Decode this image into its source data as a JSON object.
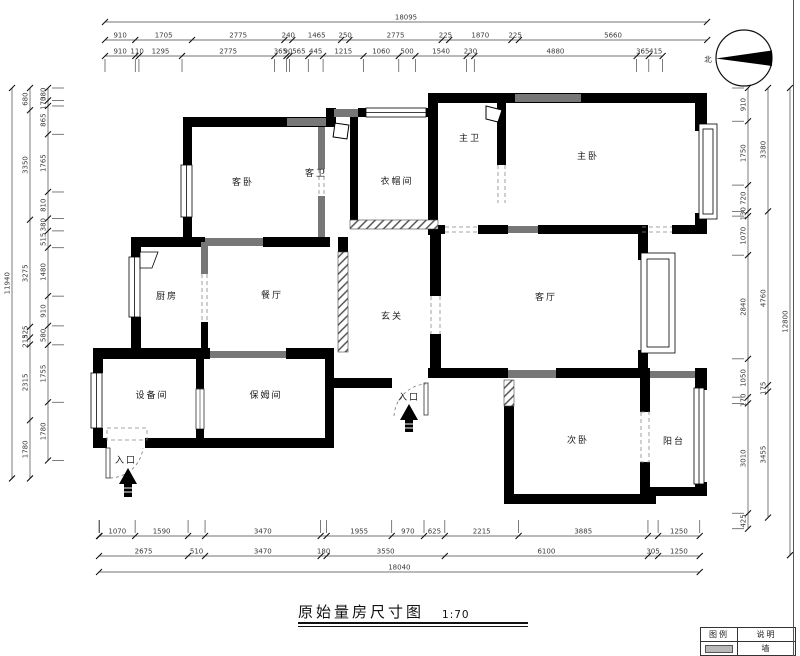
{
  "title": {
    "text": "原始量房尺寸图",
    "scale": "1:70"
  },
  "north_label": "北",
  "legend": {
    "header_symbol": "图例",
    "header_desc": "说明",
    "row1_desc": "墙"
  },
  "labels": [
    {
      "name": "客卧",
      "x": 243,
      "y": 185,
      "s": 9
    },
    {
      "name": "客卫",
      "x": 316,
      "y": 176,
      "s": 8
    },
    {
      "name": "衣帽间",
      "x": 397,
      "y": 184,
      "s": 8.5
    },
    {
      "name": "主卫",
      "x": 470,
      "y": 141,
      "s": 8
    },
    {
      "name": "主卧",
      "x": 588,
      "y": 159,
      "s": 9
    },
    {
      "name": "厨房",
      "x": 167,
      "y": 299,
      "s": 9
    },
    {
      "name": "餐厅",
      "x": 272,
      "y": 298,
      "s": 9
    },
    {
      "name": "玄关",
      "x": 392,
      "y": 319,
      "s": 9
    },
    {
      "name": "客厅",
      "x": 546,
      "y": 300,
      "s": 9
    },
    {
      "name": "设备间",
      "x": 152,
      "y": 398,
      "s": 8.5
    },
    {
      "name": "保姆间",
      "x": 266,
      "y": 398,
      "s": 8.5
    },
    {
      "name": "次卧",
      "x": 578,
      "y": 443,
      "s": 9
    },
    {
      "name": "阳台",
      "x": 674,
      "y": 444,
      "s": 8.5
    },
    {
      "name": "入口",
      "x": 409,
      "y": 400,
      "s": 7.5
    },
    {
      "name": "入口",
      "x": 126,
      "y": 463,
      "s": 7.5
    }
  ],
  "dims": {
    "top": [
      {
        "y": 22,
        "x0": 105,
        "scale": 0.03327,
        "guide": "",
        "segs": [
          [
            18095,
            "18095"
          ]
        ]
      },
      {
        "y": 40,
        "x0": 105,
        "scale": 0.03327,
        "guide": "",
        "segs": [
          [
            910,
            "910"
          ],
          [
            1705,
            "1705"
          ],
          [
            2775,
            "2775"
          ],
          [
            240,
            "240"
          ],
          [
            1465,
            "1465"
          ],
          [
            250,
            "250"
          ],
          [
            2775,
            "2775"
          ],
          [
            225,
            "225"
          ],
          [
            1870,
            "1870"
          ],
          [
            225,
            "225"
          ],
          [
            5660,
            "5660"
          ]
        ]
      },
      {
        "y": 56,
        "x0": 105,
        "scale": 0.03327,
        "guide": "down",
        "segs": [
          [
            910,
            "910"
          ],
          [
            110,
            "110"
          ],
          [
            1295,
            "1295"
          ],
          [
            2775,
            "2775"
          ],
          [
            365,
            "365"
          ],
          [
            90,
            "90"
          ],
          [
            565,
            "565"
          ],
          [
            445,
            "445"
          ],
          [
            1215,
            "1215"
          ],
          [
            1060,
            "1060"
          ],
          [
            500,
            "500"
          ],
          [
            1540,
            "1540"
          ],
          [
            230,
            "230"
          ],
          [
            4880,
            "4880"
          ],
          [
            365,
            "365"
          ],
          [
            415,
            "415"
          ]
        ]
      }
    ],
    "bottom": [
      {
        "y": 536,
        "x0": 99,
        "scale": 0.0333,
        "guide": "up",
        "segs": [
          [
            15,
            ""
          ],
          [
            1070,
            "1070"
          ],
          [
            1590,
            "1590"
          ],
          [
            510,
            ""
          ],
          [
            3470,
            "3470"
          ],
          [
            180,
            ""
          ],
          [
            1955,
            "1955"
          ],
          [
            970,
            "970"
          ],
          [
            625,
            "625"
          ],
          [
            2215,
            "2215"
          ],
          [
            3885,
            "3885"
          ],
          [
            305,
            ""
          ],
          [
            1250,
            "1250"
          ]
        ]
      },
      {
        "y": 556,
        "x0": 99,
        "scale": 0.0333,
        "guide": "",
        "segs": [
          [
            2675,
            "2675"
          ],
          [
            510,
            "510"
          ],
          [
            3470,
            "3470"
          ],
          [
            180,
            "180"
          ],
          [
            3550,
            "3550"
          ],
          [
            6100,
            "6100"
          ],
          [
            305,
            "305"
          ],
          [
            1250,
            "1250"
          ]
        ]
      },
      {
        "y": 572,
        "x0": 99,
        "scale": 0.0333,
        "guide": "",
        "segs": [
          [
            18040,
            "18040"
          ]
        ]
      }
    ],
    "left": [
      {
        "x": 12,
        "y0": 88,
        "scale": 0.0327,
        "guide": "",
        "segs": [
          [
            11940,
            "11940"
          ]
        ]
      },
      {
        "x": 30,
        "y0": 88,
        "scale": 0.0327,
        "guide": "",
        "segs": [
          [
            680,
            "680"
          ],
          [
            3350,
            "3350"
          ],
          [
            3275,
            "3275"
          ],
          [
            325,
            "325"
          ],
          [
            215,
            "215"
          ],
          [
            2315,
            "2315"
          ],
          [
            1780,
            "1780"
          ]
        ]
      },
      {
        "x": 48,
        "y0": 88,
        "scale": 0.0327,
        "guide": "right",
        "segs": [
          [
            380,
            "380"
          ],
          [
            170,
            "170"
          ],
          [
            865,
            "865"
          ],
          [
            1765,
            "1765"
          ],
          [
            810,
            "810"
          ],
          [
            380,
            "380"
          ],
          [
            515,
            "515"
          ],
          [
            1480,
            "1480"
          ],
          [
            910,
            "910"
          ],
          [
            580,
            "580"
          ],
          [
            1755,
            "1755"
          ],
          [
            1780,
            "1780"
          ]
        ]
      }
    ],
    "right": [
      {
        "x": 748,
        "y0": 88,
        "scale": 0.0365,
        "guide": "left",
        "segs": [
          [
            910,
            "910"
          ],
          [
            1750,
            "1750"
          ],
          [
            720,
            "720"
          ],
          [
            130,
            "130"
          ],
          [
            1070,
            "1070"
          ],
          [
            2840,
            "2840"
          ],
          [
            1050,
            "1050"
          ],
          [
            170,
            "170"
          ],
          [
            3010,
            "3010"
          ],
          [
            425,
            "425"
          ]
        ]
      },
      {
        "x": 768,
        "y0": 88,
        "scale": 0.0365,
        "guide": "",
        "segs": [
          [
            3380,
            "3380"
          ],
          [
            4760,
            "4760"
          ],
          [
            175,
            "175"
          ],
          [
            3455,
            "3455"
          ]
        ]
      },
      {
        "x": 790,
        "y0": 88,
        "scale": 0.0365,
        "guide": "",
        "segs": [
          [
            12800,
            "12800"
          ]
        ]
      }
    ]
  }
}
